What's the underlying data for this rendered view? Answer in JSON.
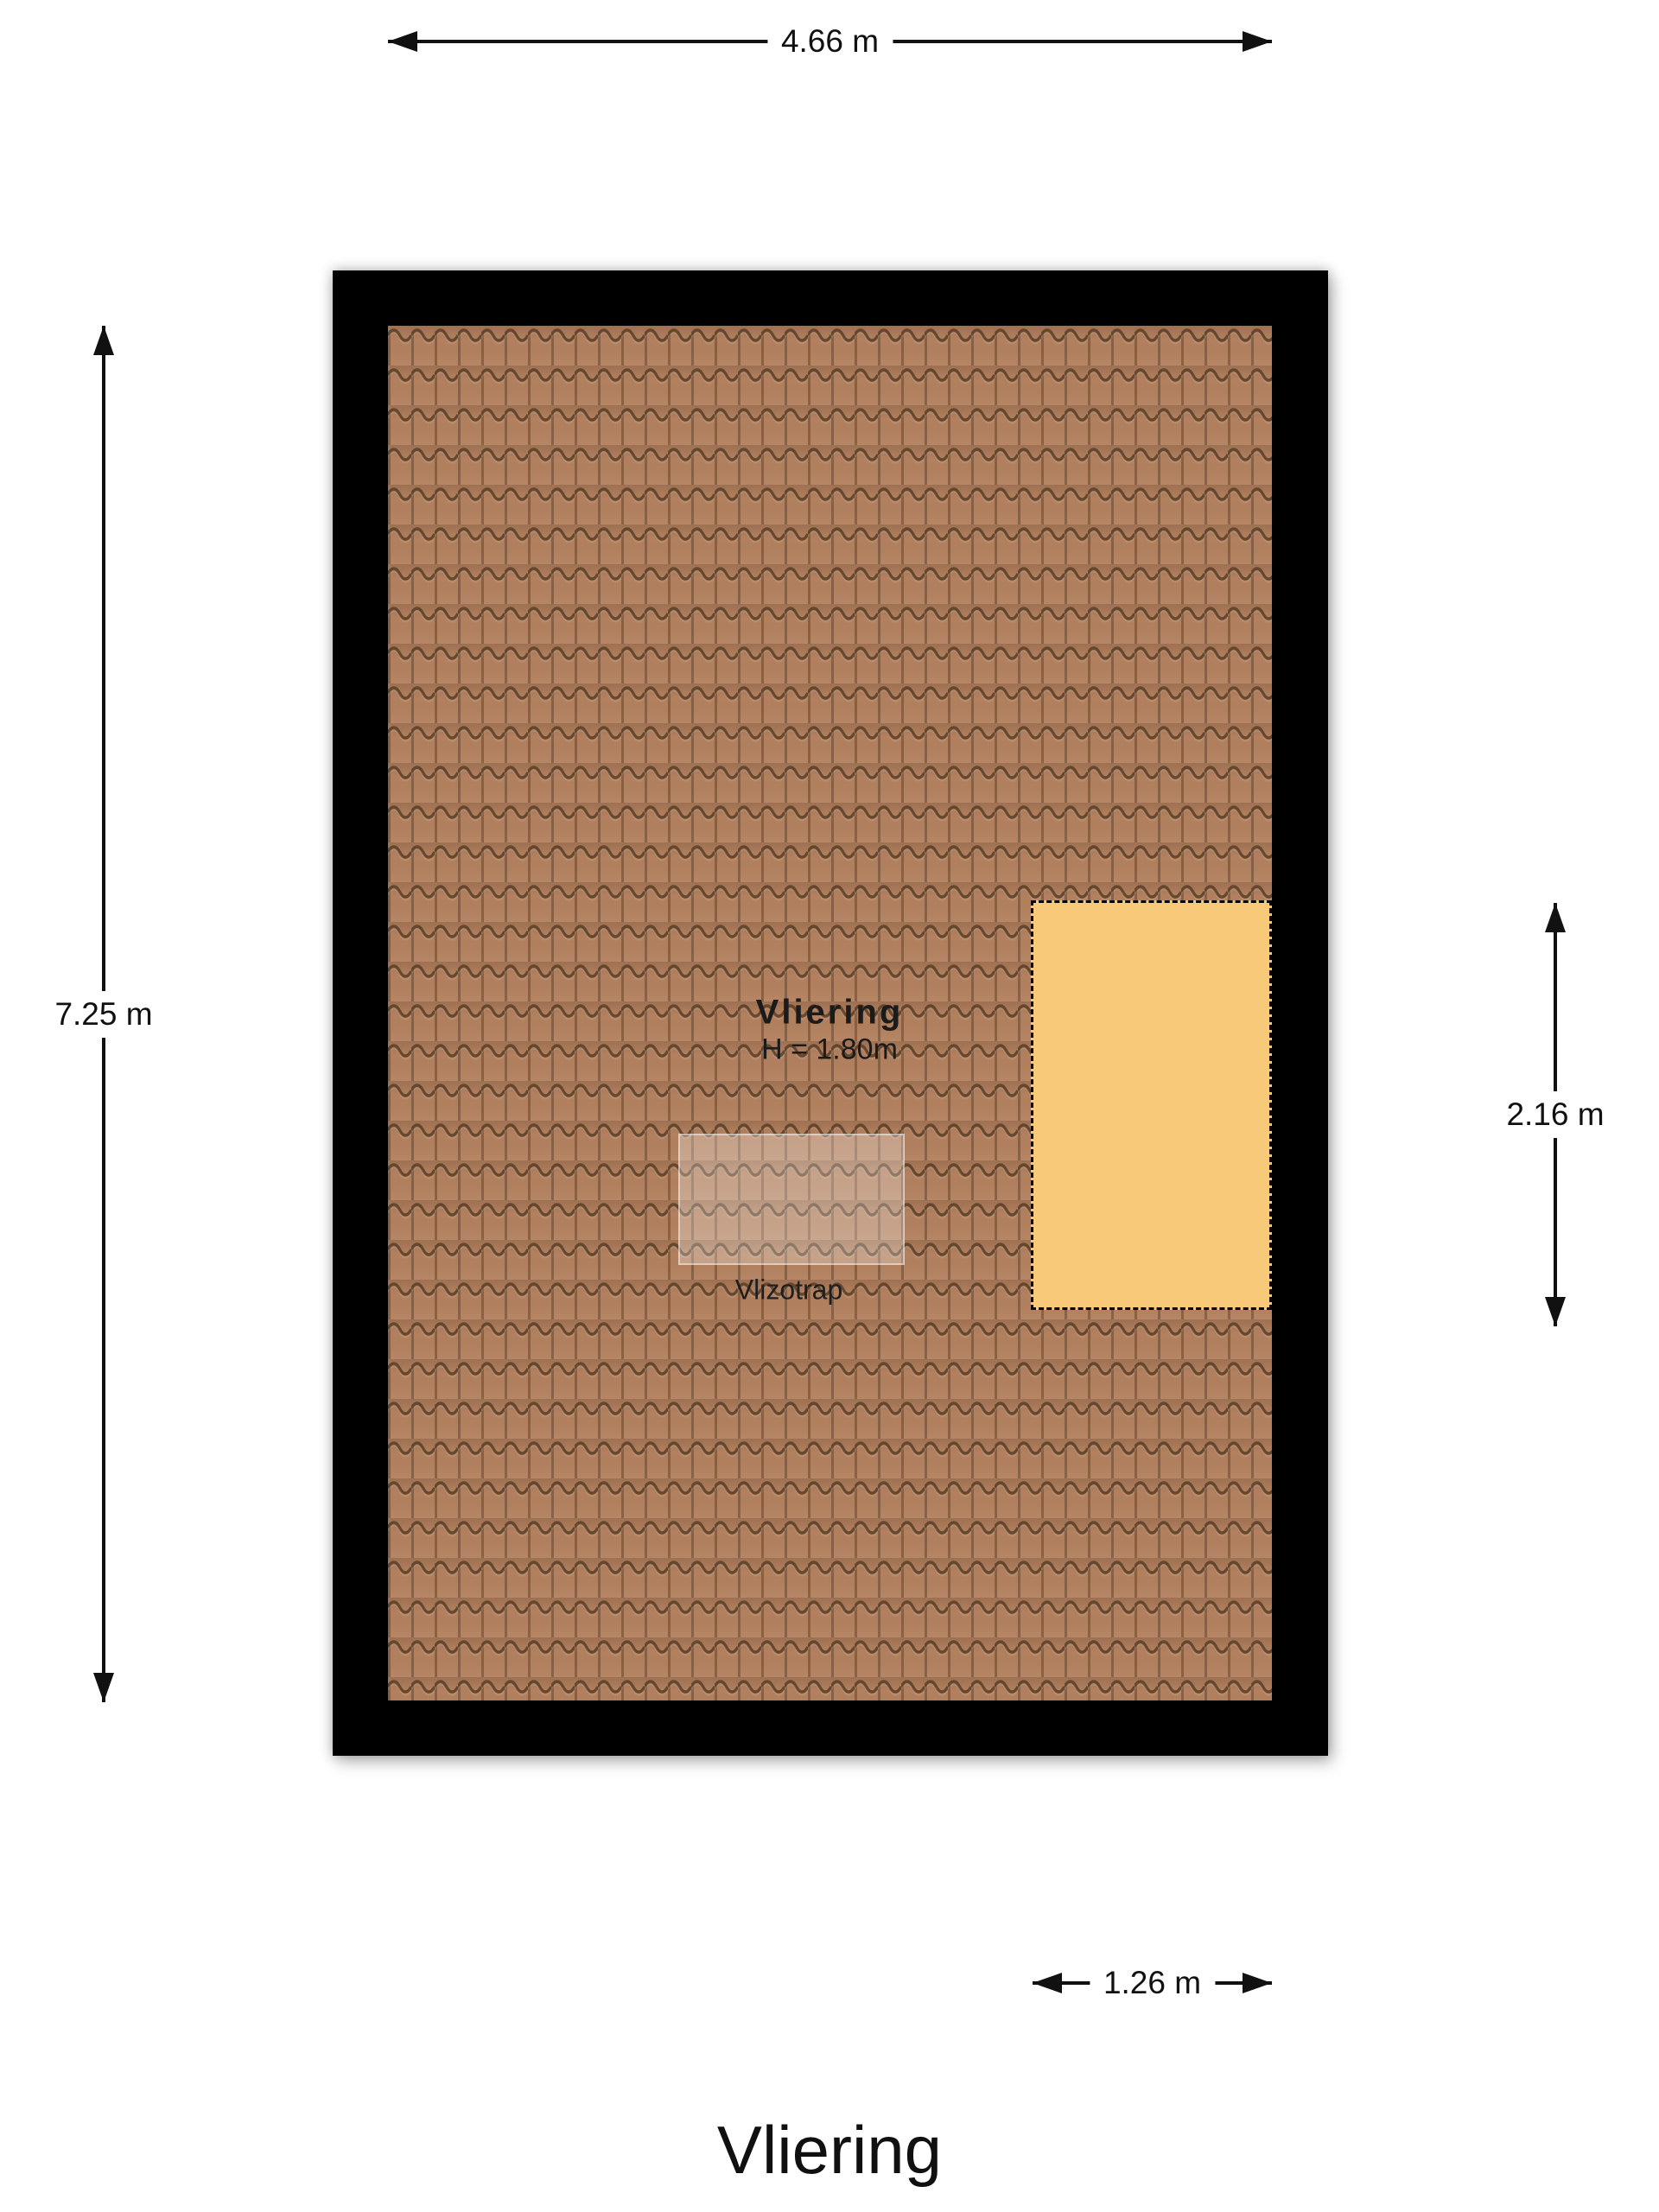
{
  "page_title": "Vliering",
  "plan": {
    "room_label": "Vliering",
    "room_height": "H = 1.80m",
    "hatch_label": "Vlizotrap"
  },
  "dimensions": {
    "width_total": "4.66 m",
    "height_total": "7.25 m",
    "loft_height": "2.16 m",
    "loft_width": "1.26 m"
  },
  "colors": {
    "wall": "#000000",
    "tile-base": "#b2805e",
    "tile-line": "#5e4129",
    "tile-joint": "#6b4b33",
    "loft-fill": "#f9c97a",
    "dim-ink": "#111111",
    "canvas-bg": "#ffffff"
  }
}
